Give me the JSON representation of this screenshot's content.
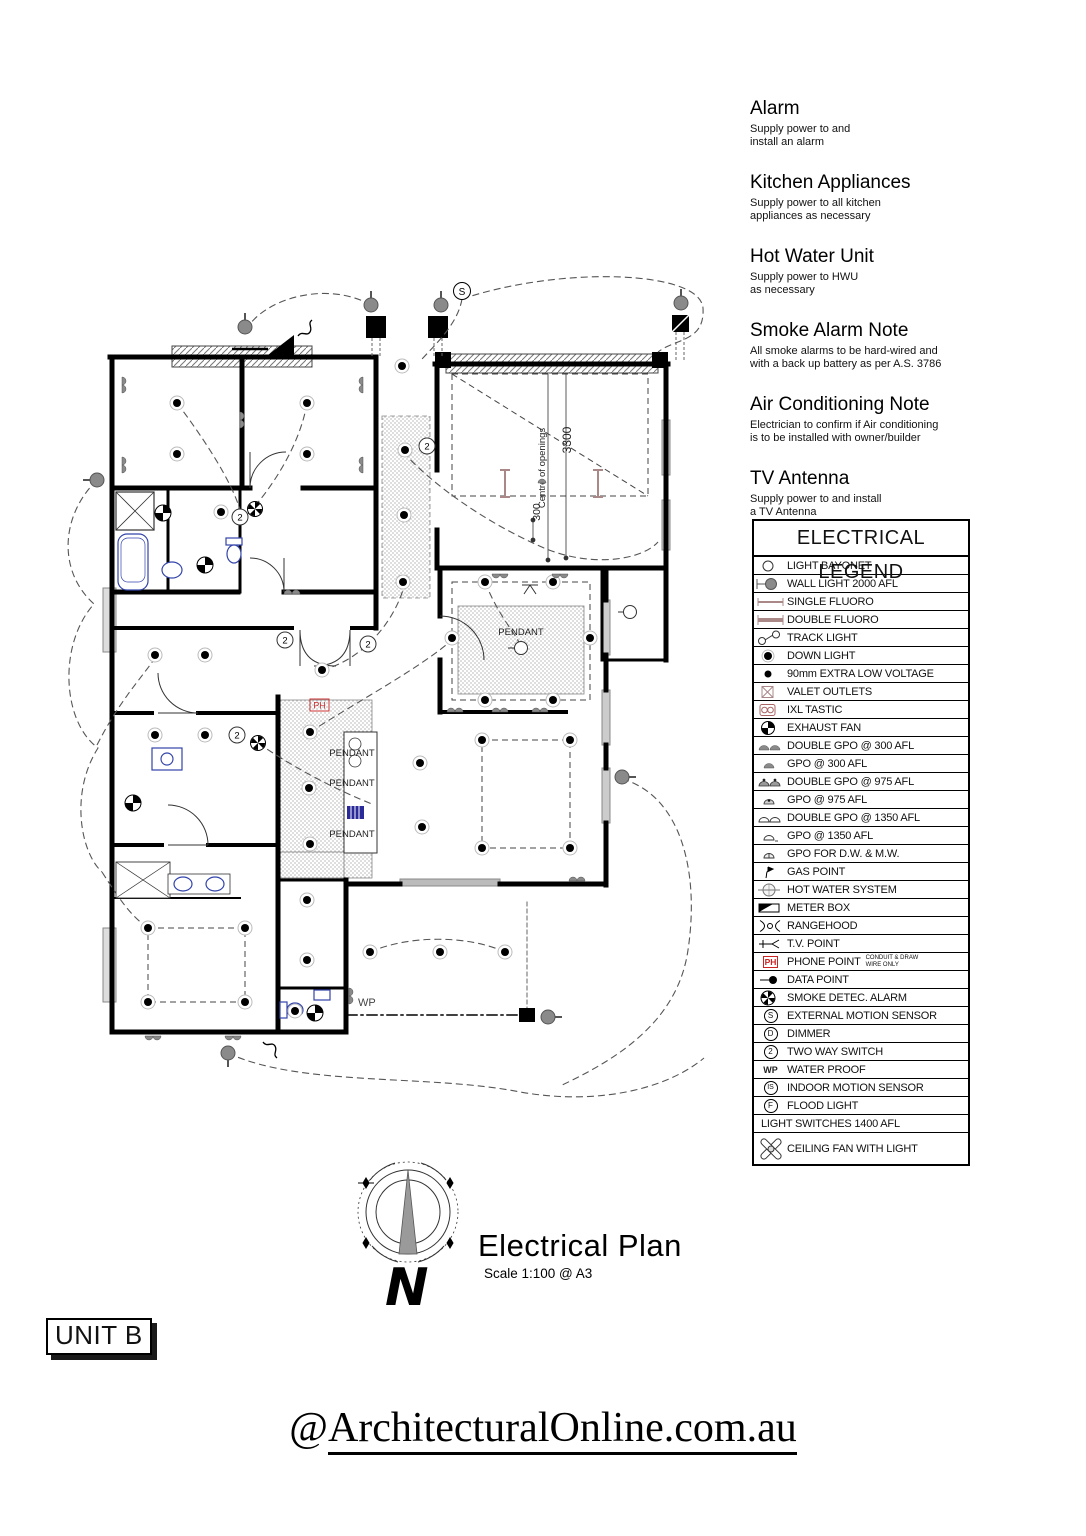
{
  "page": {
    "unit_label": "UNIT B",
    "footer_at": "@",
    "footer_domain": "ArchitecturalOnline.com.au"
  },
  "titleblock": {
    "title": "Electrical Plan",
    "scale": "Scale 1:100 @ A3",
    "north": "N"
  },
  "notes": [
    {
      "heading": "Alarm",
      "body": "Supply power to and\ninstall an alarm"
    },
    {
      "heading": "Kitchen Appliances",
      "body": "Supply power to all kitchen\nappliances as necessary"
    },
    {
      "heading": "Hot Water Unit",
      "body": "Supply power to HWU\nas necessary"
    },
    {
      "heading": "Smoke Alarm Note",
      "body": "All smoke alarms to be hard-wired and\nwith a back up battery as per A.S. 3786"
    },
    {
      "heading": "Air Conditioning Note",
      "body": "Electrician to confirm if Air conditioning\nis to be installed with owner/builder"
    },
    {
      "heading": "TV Antenna",
      "body": "Supply power to and install\na TV Antenna"
    }
  ],
  "legend": {
    "title": "ELECTRICAL LEGEND",
    "phone_note": "CONDUIT & DRAW\nWIRE ONLY",
    "items": [
      {
        "label": "LIGHT BAYONET"
      },
      {
        "label": "WALL LIGHT 2000 AFL"
      },
      {
        "label": "SINGLE FLUORO"
      },
      {
        "label": "DOUBLE FLUORO"
      },
      {
        "label": "TRACK LIGHT"
      },
      {
        "label": "DOWN LIGHT"
      },
      {
        "label": "90mm EXTRA LOW VOLTAGE"
      },
      {
        "label": "VALET OUTLETS"
      },
      {
        "label": "IXL TASTIC"
      },
      {
        "label": "EXHAUST FAN"
      },
      {
        "label": "DOUBLE GPO @ 300 AFL"
      },
      {
        "label": "GPO @ 300 AFL"
      },
      {
        "label": "DOUBLE GPO @ 975 AFL"
      },
      {
        "label": "GPO @ 975 AFL"
      },
      {
        "label": "DOUBLE GPO @ 1350 AFL"
      },
      {
        "label": "GPO @ 1350 AFL"
      },
      {
        "label": "GPO FOR D.W. & M.W."
      },
      {
        "label": "GAS POINT"
      },
      {
        "label": "HOT WATER SYSTEM"
      },
      {
        "label": "METER BOX"
      },
      {
        "label": "RANGEHOOD"
      },
      {
        "label": "T.V. POINT"
      },
      {
        "label": "PHONE POINT",
        "sym": "PH"
      },
      {
        "label": "DATA POINT"
      },
      {
        "label": "SMOKE DETEC. ALARM"
      },
      {
        "label": "EXTERNAL MOTION SENSOR",
        "sym": "S"
      },
      {
        "label": "DIMMER",
        "sym": "D"
      },
      {
        "label": "TWO WAY SWITCH",
        "sym": "2"
      },
      {
        "label": "WATER PROOF",
        "sym": "WP"
      },
      {
        "label": "INDOOR MOTION SENSOR",
        "sym": "IS"
      },
      {
        "label": "FLOOD LIGHT",
        "sym": "F"
      },
      {
        "label": "LIGHT SWITCHES 1400 AFL"
      },
      {
        "label": "CEILING FAN WITH LIGHT"
      }
    ]
  },
  "plan": {
    "pendant": "PENDANT",
    "ph": "PH",
    "wp": "WP",
    "two_way": "2",
    "ext_sensor": "S",
    "dim_centre": "Centre of openings",
    "dim_3300": "3300",
    "dim_300": "300"
  }
}
